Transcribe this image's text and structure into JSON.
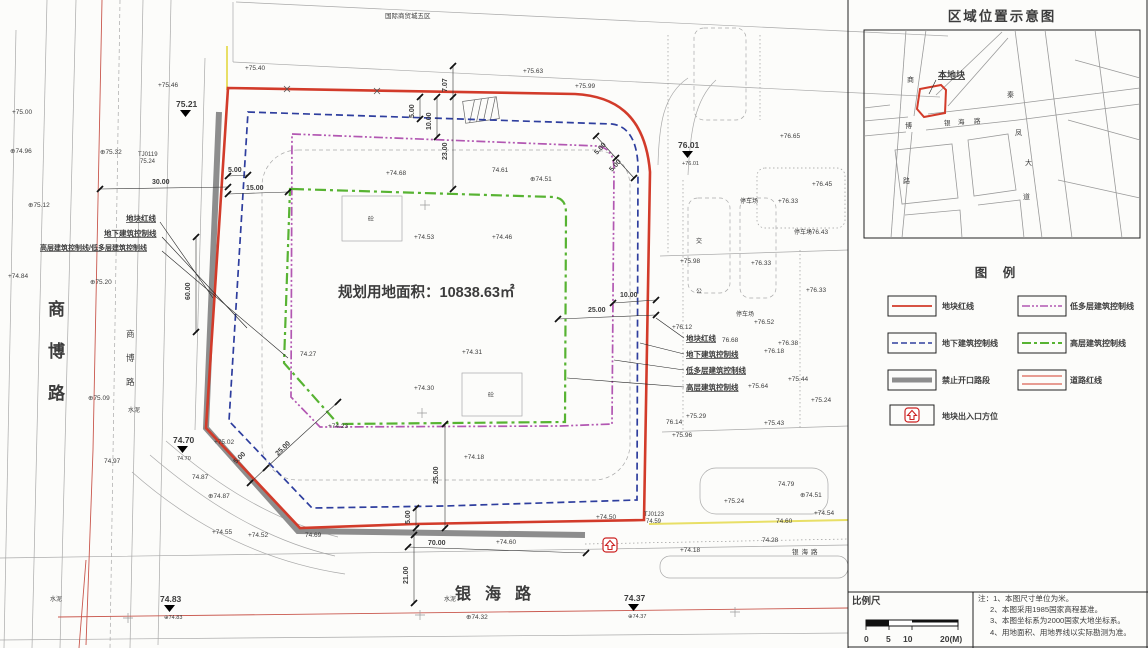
{
  "colors": {
    "parcel_red": "#d23b2a",
    "underground_blue": "#2e3e9e",
    "lowrise_purple": "#b257b2",
    "highrise_green": "#57b332",
    "no_opening_gray": "#8d8d8d",
    "road_red": "#c9574d",
    "utility_yellow": "#e8df66"
  },
  "plan": {
    "area_label": "规划用地面积：10838.63㎡",
    "texts": [
      {
        "t": "+75.40",
        "x": 245,
        "y": 70
      },
      {
        "t": "+75.63",
        "x": 523,
        "y": 73
      },
      {
        "t": "+75.99",
        "x": 575,
        "y": 88
      },
      {
        "t": "+75.46",
        "x": 158,
        "y": 87
      },
      {
        "t": "⊕75.12",
        "x": 28,
        "y": 207
      },
      {
        "t": "+75.00",
        "x": 12,
        "y": 114
      },
      {
        "t": "⊕74.96",
        "x": 10,
        "y": 153
      },
      {
        "t": "+74.84",
        "x": 8,
        "y": 278
      },
      {
        "t": "⊕75.32",
        "x": 100,
        "y": 154
      },
      {
        "t": "⊕75.20",
        "x": 90,
        "y": 284
      },
      {
        "t": "⊕75.09",
        "x": 88,
        "y": 400
      },
      {
        "t": "74.97",
        "x": 104,
        "y": 463
      },
      {
        "t": "+75.02",
        "x": 214,
        "y": 444
      },
      {
        "t": "74.87",
        "x": 192,
        "y": 479
      },
      {
        "t": "⊕74.87",
        "x": 208,
        "y": 498
      },
      {
        "t": "+74.68",
        "x": 386,
        "y": 175
      },
      {
        "t": "74.61",
        "x": 492,
        "y": 172
      },
      {
        "t": "+74.53",
        "x": 414,
        "y": 239
      },
      {
        "t": "+74.46",
        "x": 492,
        "y": 239
      },
      {
        "t": "⊕74.51",
        "x": 530,
        "y": 181
      },
      {
        "t": "+74.31",
        "x": 462,
        "y": 354
      },
      {
        "t": "+74.30",
        "x": 414,
        "y": 390
      },
      {
        "t": "74.27",
        "x": 300,
        "y": 356
      },
      {
        "t": "+74.23",
        "x": 328,
        "y": 428
      },
      {
        "t": "+74.18",
        "x": 464,
        "y": 459
      },
      {
        "t": "+74.55",
        "x": 212,
        "y": 534
      },
      {
        "t": "+74.52",
        "x": 248,
        "y": 537
      },
      {
        "t": "74.69",
        "x": 305,
        "y": 537
      },
      {
        "t": "+74.60",
        "x": 496,
        "y": 544
      },
      {
        "t": "+76.12",
        "x": 672,
        "y": 329
      },
      {
        "t": "+76.52",
        "x": 754,
        "y": 324
      },
      {
        "t": "76.68",
        "x": 722,
        "y": 342
      },
      {
        "t": "+76.38",
        "x": 778,
        "y": 345
      },
      {
        "t": "+76.18",
        "x": 764,
        "y": 353
      },
      {
        "t": "+75.44",
        "x": 788,
        "y": 381
      },
      {
        "t": "+75.64",
        "x": 748,
        "y": 388
      },
      {
        "t": "+76.43",
        "x": 808,
        "y": 234
      },
      {
        "t": "+75.98",
        "x": 680,
        "y": 263
      },
      {
        "t": "+76.33",
        "x": 751,
        "y": 265
      },
      {
        "t": "+76.33",
        "x": 806,
        "y": 292
      },
      {
        "t": "+75.24",
        "x": 811,
        "y": 402
      },
      {
        "t": "+75.29",
        "x": 686,
        "y": 418
      },
      {
        "t": "76.14",
        "x": 666,
        "y": 424
      },
      {
        "t": "+75.43",
        "x": 764,
        "y": 425
      },
      {
        "t": "+75.96",
        "x": 672,
        "y": 437
      },
      {
        "t": "+76.65",
        "x": 780,
        "y": 138
      },
      {
        "t": "+76.45",
        "x": 812,
        "y": 186
      },
      {
        "t": "+76.33",
        "x": 778,
        "y": 203
      },
      {
        "t": "74.79",
        "x": 778,
        "y": 486
      },
      {
        "t": "⊕74.51",
        "x": 800,
        "y": 497
      },
      {
        "t": "+75.24",
        "x": 724,
        "y": 503
      },
      {
        "t": "+74.54",
        "x": 814,
        "y": 515
      },
      {
        "t": "+74.50",
        "x": 596,
        "y": 519
      },
      {
        "t": "74.60",
        "x": 776,
        "y": 523
      },
      {
        "t": "74.28",
        "x": 762,
        "y": 542
      },
      {
        "t": "+74.18",
        "x": 680,
        "y": 552
      },
      {
        "t": "⊕74.32",
        "x": 466,
        "y": 619
      },
      {
        "t": "水泥",
        "x": 128,
        "y": 412,
        "s": 6,
        "c": "#666"
      },
      {
        "t": "水泥",
        "x": 50,
        "y": 601,
        "s": 6,
        "c": "#666"
      },
      {
        "t": "水泥",
        "x": 444,
        "y": 601,
        "s": 6,
        "c": "#666"
      },
      {
        "t": "停车场",
        "x": 736,
        "y": 316,
        "s": 6,
        "c": "#555"
      },
      {
        "t": "停车场",
        "x": 794,
        "y": 234,
        "s": 6,
        "c": "#555"
      },
      {
        "t": "停车场",
        "x": 740,
        "y": 203,
        "s": 6,
        "c": "#555"
      },
      {
        "t": "公",
        "x": 696,
        "y": 293,
        "s": 6,
        "c": "#555"
      },
      {
        "t": "交",
        "x": 696,
        "y": 243,
        "s": 6,
        "c": "#555"
      },
      {
        "t": "TJ0119",
        "x": 138,
        "y": 156,
        "s": 6,
        "c": "#555"
      },
      {
        "t": "75.24",
        "x": 140,
        "y": 163,
        "s": 6,
        "c": "#555"
      },
      {
        "t": "TJ0123",
        "x": 644,
        "y": 516,
        "s": 6,
        "c": "#555"
      },
      {
        "t": "74.59",
        "x": 646,
        "y": 523,
        "s": 6,
        "c": "#555"
      },
      {
        "t": "银海路",
        "x": 792,
        "y": 554,
        "s": 6.5,
        "ls": 3,
        "c": "#555"
      },
      {
        "t": "国际商贸城五区",
        "x": 385,
        "y": 18,
        "s": 6.5,
        "c": "#777"
      },
      {
        "t": "砼",
        "x": 368,
        "y": 221,
        "s": 6,
        "c": "#555"
      },
      {
        "t": "砼",
        "x": 488,
        "y": 397,
        "s": 6,
        "c": "#555"
      },
      {
        "t": "30.00",
        "x": 152,
        "y": 184,
        "s": 7,
        "c": "#111",
        "w": 1
      },
      {
        "t": "5.00",
        "x": 228,
        "y": 172,
        "s": 7,
        "c": "#111",
        "w": 1
      },
      {
        "t": "15.00",
        "x": 246,
        "y": 190,
        "s": 7,
        "c": "#111",
        "w": 1
      },
      {
        "t": "60.00",
        "x": 190,
        "y": 300,
        "s": 7,
        "c": "#111",
        "w": 1,
        "r": -90
      },
      {
        "t": "7.07",
        "x": 447,
        "y": 92,
        "s": 7,
        "c": "#111",
        "w": 1,
        "r": -90
      },
      {
        "t": "5.00",
        "x": 414,
        "y": 118,
        "s": 7,
        "c": "#111",
        "w": 1,
        "r": -90
      },
      {
        "t": "10.00",
        "x": 431,
        "y": 130,
        "s": 7,
        "c": "#111",
        "w": 1,
        "r": -90
      },
      {
        "t": "23.00",
        "x": 447,
        "y": 160,
        "s": 7,
        "c": "#111",
        "w": 1,
        "r": -90
      },
      {
        "t": "5.00",
        "x": 597,
        "y": 155,
        "s": 7,
        "c": "#111",
        "w": 1,
        "r": -47
      },
      {
        "t": "5.00",
        "x": 612,
        "y": 172,
        "s": 7,
        "c": "#111",
        "w": 1,
        "r": -47
      },
      {
        "t": "10.00",
        "x": 620,
        "y": 297,
        "s": 7,
        "c": "#111",
        "w": 1
      },
      {
        "t": "25.00",
        "x": 588,
        "y": 312,
        "s": 7,
        "c": "#111",
        "w": 1
      },
      {
        "t": "25.00",
        "x": 438,
        "y": 484,
        "s": 7,
        "c": "#111",
        "w": 1,
        "r": -90
      },
      {
        "t": "5.00",
        "x": 410,
        "y": 524,
        "s": 7,
        "c": "#111",
        "w": 1,
        "r": -90
      },
      {
        "t": "25.00",
        "x": 278,
        "y": 456,
        "s": 7,
        "c": "#111",
        "w": 1,
        "r": -44
      },
      {
        "t": "5.00",
        "x": 236,
        "y": 464,
        "s": 7,
        "c": "#111",
        "w": 1,
        "r": -44
      },
      {
        "t": "70.00",
        "x": 428,
        "y": 545,
        "s": 7,
        "c": "#111",
        "w": 1
      },
      {
        "t": "21.00",
        "x": 408,
        "y": 584,
        "s": 7,
        "c": "#111",
        "w": 1,
        "r": -90
      },
      {
        "t": "地块红线",
        "x": 126,
        "y": 221,
        "s": 7.5,
        "c": "#000",
        "w": 1,
        "u": 1
      },
      {
        "t": "地下建筑控制线",
        "x": 104,
        "y": 236,
        "s": 7.5,
        "c": "#000",
        "w": 1,
        "u": 1
      },
      {
        "t": "高层建筑控制线/低多层建筑控制线",
        "x": 40,
        "y": 250,
        "s": 7,
        "c": "#000",
        "w": 1,
        "u": 1
      },
      {
        "t": "地块红线",
        "x": 686,
        "y": 341,
        "s": 7.5,
        "c": "#000",
        "w": 1,
        "u": 1
      },
      {
        "t": "地下建筑控制线",
        "x": 686,
        "y": 357,
        "s": 7.5,
        "c": "#000",
        "w": 1,
        "u": 1
      },
      {
        "t": "低多层建筑控制线",
        "x": 686,
        "y": 373,
        "s": 7.5,
        "c": "#000",
        "w": 1,
        "u": 1
      },
      {
        "t": "高层建筑控制线",
        "x": 686,
        "y": 390,
        "s": 7.5,
        "c": "#000",
        "w": 1,
        "u": 1
      },
      {
        "t": "商",
        "x": 48,
        "y": 315,
        "s": 17,
        "c": "#111",
        "w": 1
      },
      {
        "t": "博",
        "x": 48,
        "y": 357,
        "s": 17,
        "c": "#111",
        "w": 1
      },
      {
        "t": "路",
        "x": 48,
        "y": 399,
        "s": 17,
        "c": "#111",
        "w": 1
      },
      {
        "t": "商",
        "x": 126,
        "y": 337,
        "s": 8.5,
        "c": "#333"
      },
      {
        "t": "博",
        "x": 126,
        "y": 361,
        "s": 8.5,
        "c": "#333"
      },
      {
        "t": "路",
        "x": 126,
        "y": 385,
        "s": 8.5,
        "c": "#333"
      },
      {
        "t": "银海路",
        "x": 455,
        "y": 599,
        "s": 16,
        "c": "#111",
        "w": 1,
        "ls": 14
      }
    ],
    "benchmarks": [
      {
        "v": "75.21",
        "x": 176,
        "y": 107,
        "sub": ""
      },
      {
        "v": "76.01",
        "x": 678,
        "y": 148,
        "sub": "+76.01"
      },
      {
        "v": "74.70",
        "x": 173,
        "y": 443,
        "sub": "74.70"
      },
      {
        "v": "74.83",
        "x": 160,
        "y": 602,
        "sub": "⊕74.83"
      },
      {
        "v": "74.37",
        "x": 624,
        "y": 601,
        "sub": "⊕74.37"
      }
    ]
  },
  "inset": {
    "title": "区域位置示意图",
    "labels": [
      {
        "t": "本地块",
        "x": 938,
        "y": 78,
        "s": 9,
        "c": "#000",
        "w": 1,
        "u": 1
      },
      {
        "t": "商",
        "x": 907,
        "y": 82,
        "s": 7,
        "c": "#444"
      },
      {
        "t": "博",
        "x": 905,
        "y": 128,
        "s": 7,
        "c": "#444"
      },
      {
        "t": "路",
        "x": 903,
        "y": 183,
        "s": 7,
        "c": "#444"
      },
      {
        "t": "银",
        "x": 944,
        "y": 125,
        "s": 6.5,
        "c": "#444"
      },
      {
        "t": "海",
        "x": 958,
        "y": 124,
        "s": 6.5,
        "c": "#444"
      },
      {
        "t": "路",
        "x": 974,
        "y": 123,
        "s": 6.5,
        "c": "#444"
      },
      {
        "t": "秦",
        "x": 1007,
        "y": 97,
        "s": 7,
        "c": "#444"
      },
      {
        "t": "凤",
        "x": 1015,
        "y": 135,
        "s": 7,
        "c": "#444"
      },
      {
        "t": "大",
        "x": 1025,
        "y": 165,
        "s": 7,
        "c": "#444"
      },
      {
        "t": "道",
        "x": 1023,
        "y": 199,
        "s": 7,
        "c": "#444"
      }
    ]
  },
  "legend": {
    "title": "图  例",
    "items": [
      {
        "label": "地块红线",
        "style": "red-solid"
      },
      {
        "label": "地下建筑控制线",
        "style": "blue-dashed"
      },
      {
        "label": "禁止开口路段",
        "style": "gray-thick"
      },
      {
        "label": "地块出入口方位",
        "style": "entrance-arrow"
      },
      {
        "label": "低多层建筑控制线",
        "style": "purple-dashdotdot"
      },
      {
        "label": "高层建筑控制线",
        "style": "green-dashdot"
      },
      {
        "label": "道路红线",
        "style": "red-double"
      }
    ]
  },
  "scalebar": {
    "label": "比例尺",
    "ticks": [
      "0",
      "5",
      "10",
      "20(M)"
    ]
  },
  "notes": {
    "lines": [
      "注：1、本图尺寸单位为米。",
      "2、本图采用1985国家高程基准。",
      "3、本图坐标系为2000国家大地坐标系。",
      "4、用地面积、用地界线以实际勘测为准。"
    ]
  }
}
